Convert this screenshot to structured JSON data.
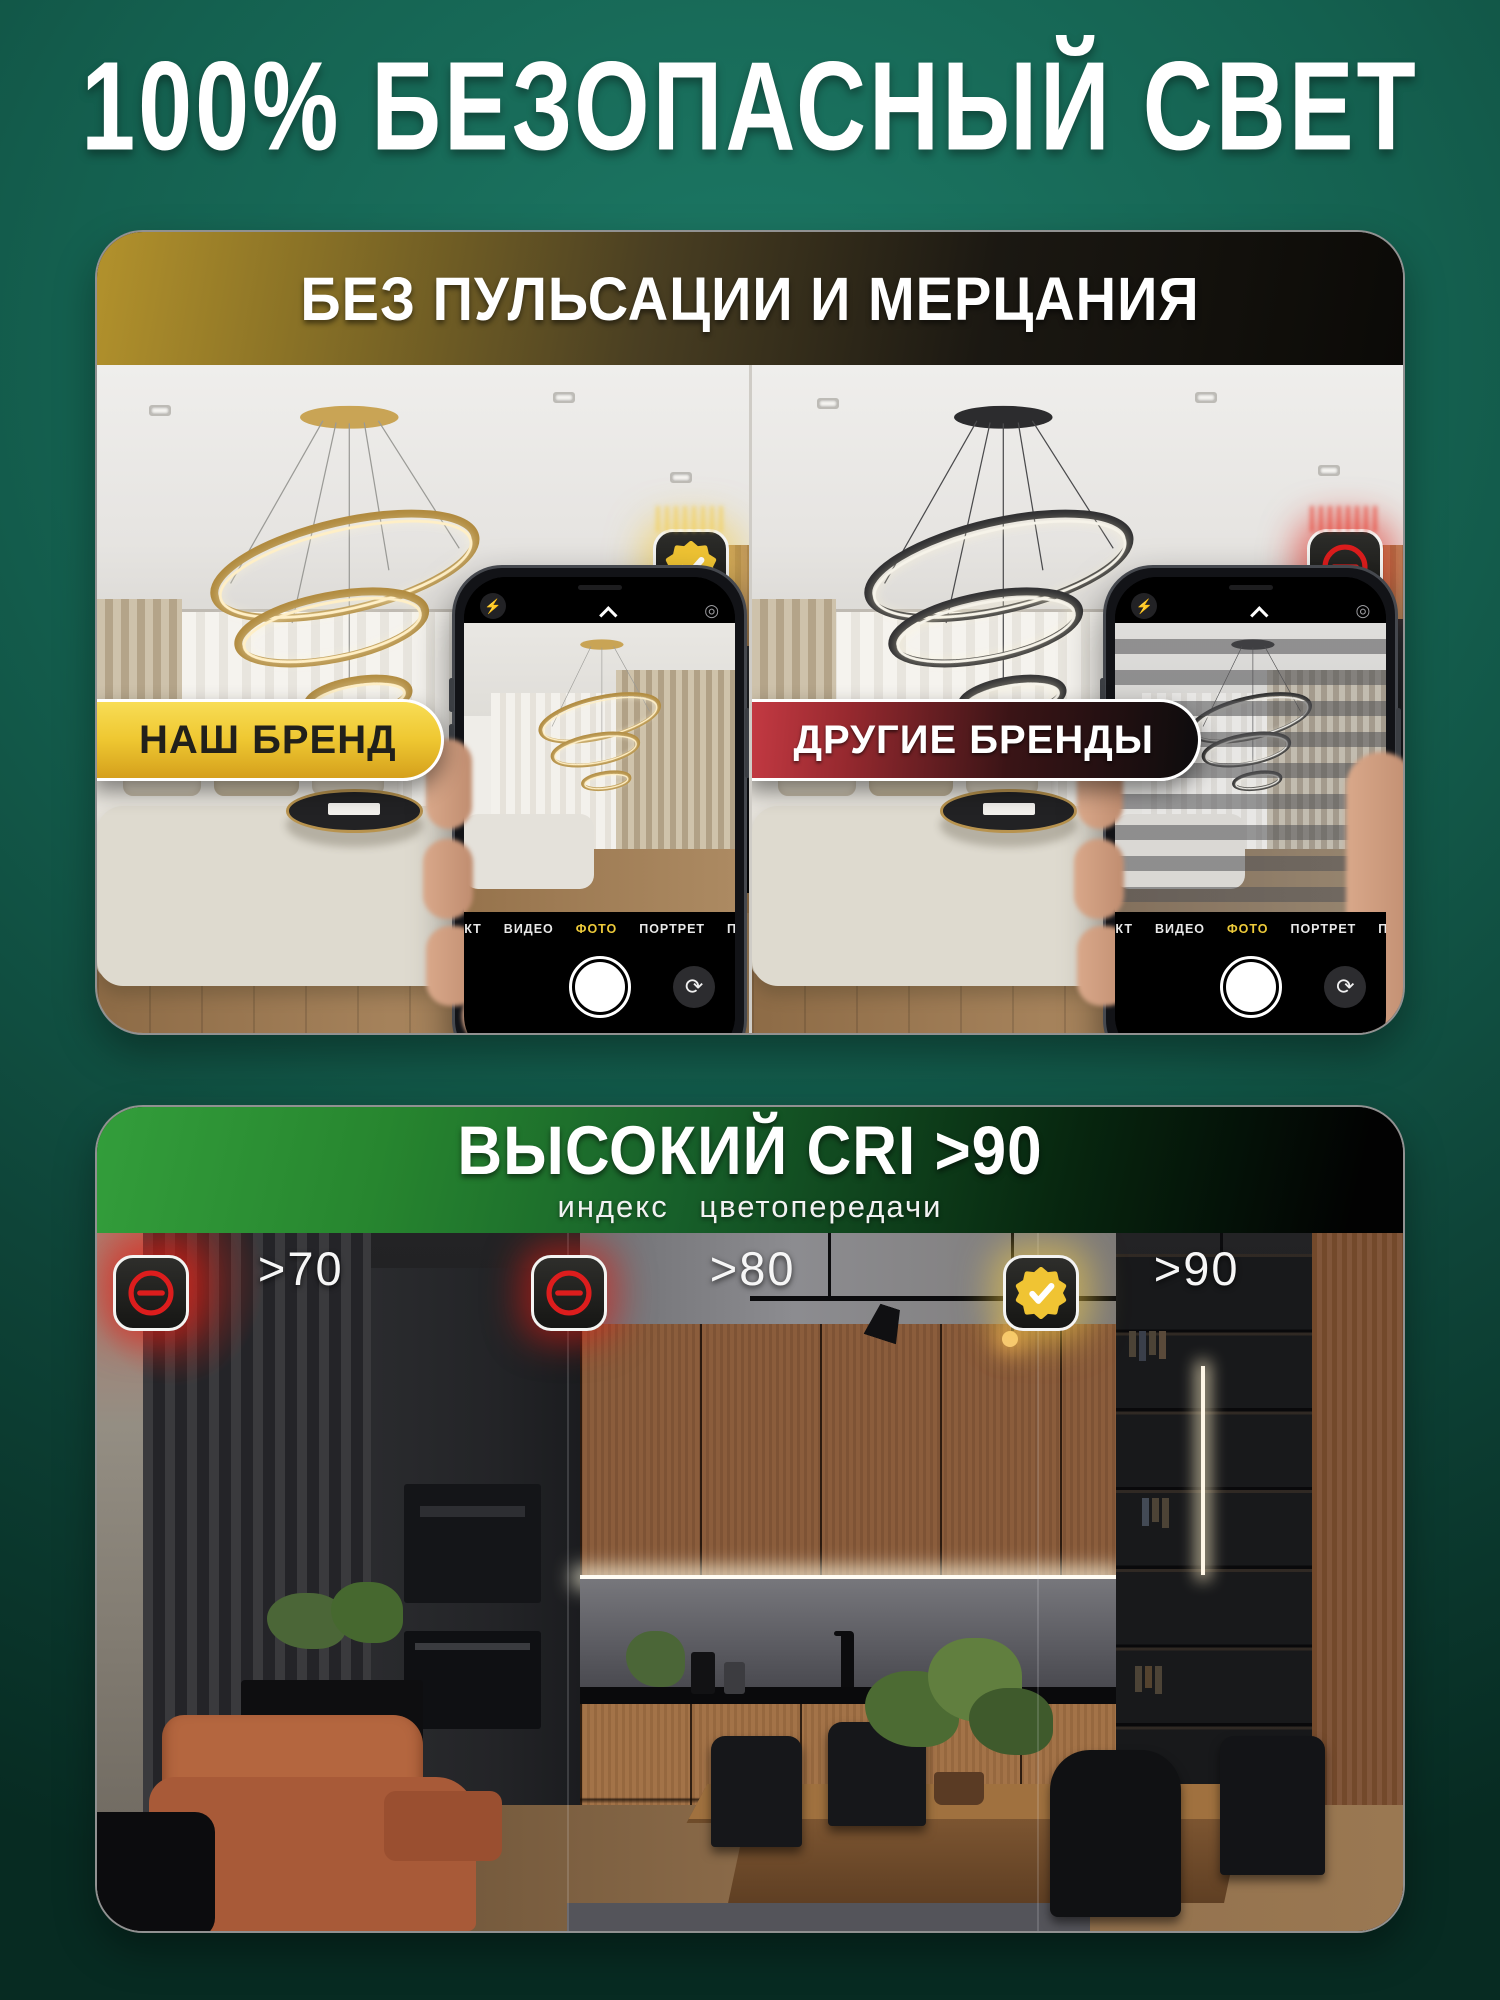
{
  "page": {
    "title": "100% БЕЗОПАСНЫЙ СВЕТ"
  },
  "colors": {
    "gold": "#f2c93c",
    "red": "#d81f1f",
    "green": "#2f9838",
    "background_green": "#14604f"
  },
  "flicker_card": {
    "header": "БЕЗ ПУЛЬСАЦИИ И МЕРЦАНИЯ",
    "our_brand": {
      "badge": "НАШ БРЕНД",
      "status_icon": "check-seal"
    },
    "other_brands": {
      "badge": "ДРУГИЕ БРЕНДЫ",
      "status_icon": "prohibition-minus"
    },
    "camera_ui": {
      "modes": [
        "ЭФФЕКТ",
        "ВИДЕО",
        "ФОТО",
        "ПОРТРЕТ",
        "ПАНОР"
      ],
      "active_mode": "ФОТО"
    }
  },
  "cri_card": {
    "title": "ВЫСОКИЙ CRI >90",
    "subtitle": "индекс  цветопередачи",
    "zones": [
      {
        "label": ">70",
        "status": "bad"
      },
      {
        "label": ">80",
        "status": "bad"
      },
      {
        "label": ">90",
        "status": "good"
      }
    ]
  }
}
